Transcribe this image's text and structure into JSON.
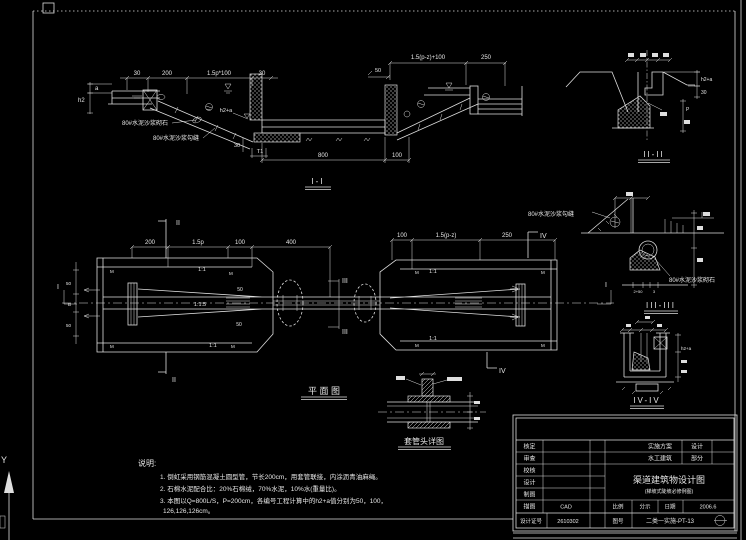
{
  "labels": {
    "masonry": "80#水泥沙浆砌石",
    "grout": "80#水泥沙浆勾缝"
  },
  "ucs": {
    "axis_label": "Y"
  },
  "section_i": {
    "title": "I-I",
    "dim_30a": "30",
    "dim_200": "200",
    "dim_slope": "1.5p*100",
    "dim_30b": "30",
    "dim_a": "a",
    "dim_h2": "h2",
    "dim_h2a": "h2+a",
    "dim_30c": "30",
    "dim_t1": "T1",
    "dim_800": "800",
    "dim_100": "100",
    "dim_right": "1.5(p-z)+100",
    "dim_250": "250",
    "dim_50": "50"
  },
  "section_ii": {
    "title": "II-II",
    "dim_h2a": "h2+a",
    "dim_30": "30",
    "dim_p": "P"
  },
  "plan": {
    "title": "平 面 图",
    "dim_200": "200",
    "dim_15p": "1.5p",
    "dim_100": "100",
    "dim_400": "400",
    "dim_100r": "100",
    "dim_15pz": "1.5(p-z)",
    "dim_250": "250",
    "slope_11": "1:1",
    "slope_115": "1:1.5",
    "dim_50": "50",
    "dim_b": "B",
    "tie_mark": "M",
    "marker_i": "I",
    "marker_ii": "II",
    "marker_iii": "III",
    "marker_iv": "IV"
  },
  "section_iii": {
    "title": "III-III",
    "dim_2_50": "2+50",
    "dim_3": "3"
  },
  "section_iv": {
    "title": "IV-IV",
    "dim_h2a": "h2+a"
  },
  "detail_joint": {
    "title": "套管头详图"
  },
  "notes": {
    "heading": "说明:",
    "line1": "1. 倒虹采用钢筋混凝土圆型管，节长200cm，用套管联接，内涂沥青油麻绳。",
    "line2": "2. 石棉水泥配合比：20%石棉绒，70%水泥，10%水(重量比)。",
    "line3": "3. 本图以Q=800L/S，P=200cm，各编号工程计算中的h2+a值分别为50，100，",
    "line4": "126,126,126cm。"
  },
  "title_block": {
    "row_labels": [
      "核定",
      "审查",
      "校核",
      "设计",
      "制图",
      "描图"
    ],
    "trace_value": "CAD",
    "cert_label": "设计证号",
    "cert_value": "2610302",
    "stage_label": "实施方案",
    "stage_value": "设计",
    "part_label": "水工建筑",
    "part_value": "部分",
    "title": "渠道建筑物设计图",
    "subtitle": "(梯坡式陡坡必修例图)",
    "scale_label": "比例",
    "scale_value": "分示",
    "date_label": "日期",
    "date_value": "2006.6",
    "no_label": "图号",
    "no_value": "二类一实施-PT-13"
  }
}
